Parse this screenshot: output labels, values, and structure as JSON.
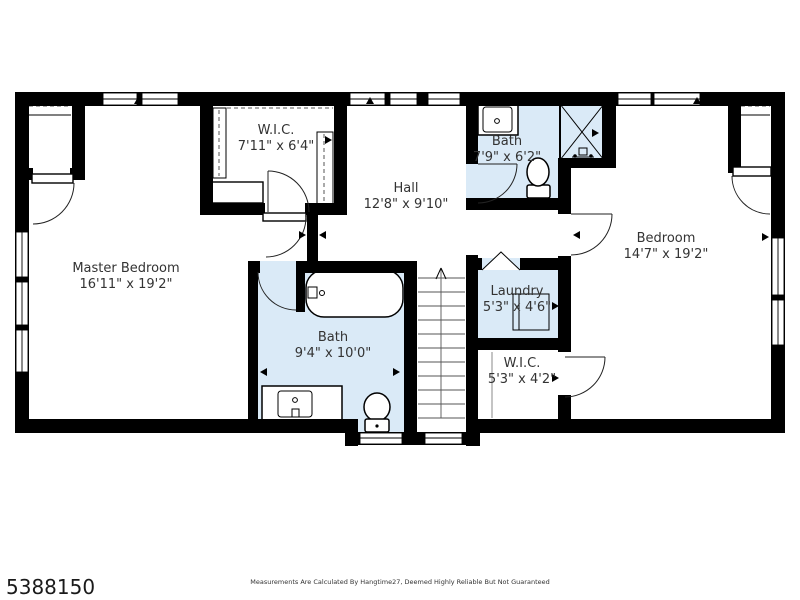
{
  "plan": {
    "rooms": [
      {
        "id": "master-bedroom",
        "name": "Master Bedroom",
        "dims": "16'11\" x 19'2\""
      },
      {
        "id": "wic-top",
        "name": "W.I.C.",
        "dims": "7'11\" x 6'4\""
      },
      {
        "id": "hall",
        "name": "Hall",
        "dims": "12'8\" x 9'10\""
      },
      {
        "id": "bath-top",
        "name": "Bath",
        "dims": "7'9\" x 6'2\""
      },
      {
        "id": "bedroom",
        "name": "Bedroom",
        "dims": "14'7\" x 19'2\""
      },
      {
        "id": "bath-main",
        "name": "Bath",
        "dims": "9'4\" x 10'0\""
      },
      {
        "id": "laundry",
        "name": "Laundry",
        "dims": "5'3\" x 4'6\""
      },
      {
        "id": "wic-bottom",
        "name": "W.I.C.",
        "dims": "5'3\" x 4'2\""
      }
    ],
    "colors": {
      "wall": "#000000",
      "wet_room_fill": "#daeaf7",
      "floor": "#ffffff",
      "label_text": "#333333"
    }
  },
  "footer": {
    "listing_id": "5388150",
    "disclaimer": "Measurements Are Calculated By Hangtime27, Deemed Highly Reliable But Not Guaranteed"
  }
}
